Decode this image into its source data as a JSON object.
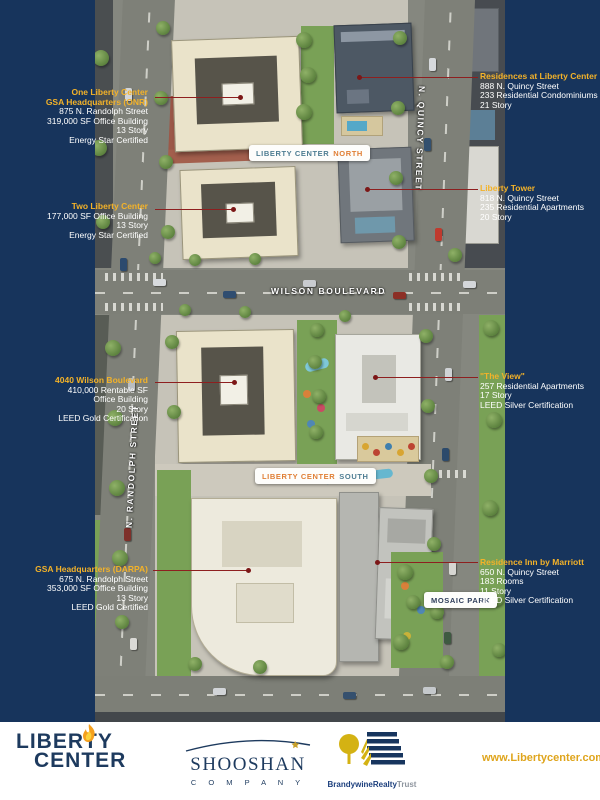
{
  "colors": {
    "background_navy": "#17345c",
    "callout_title_gold": "#f3b229",
    "callout_body_white": "#ffffff",
    "callout_line_red": "#8e1f1f",
    "banner_blue": "#4e7d92",
    "banner_orange": "#e07f35",
    "url_gold": "#dfa51d"
  },
  "callouts": {
    "left": [
      {
        "title": [
          "One Liberty Center",
          "GSA Headquarters (ONR)"
        ],
        "lines": [
          "875 N. Randolph Street",
          "319,000 SF Office Building",
          "13  Story",
          "Energy Star Certified"
        ]
      },
      {
        "title": [
          "Two Liberty Center"
        ],
        "lines": [
          "177,000 SF Office Building",
          "13 Story",
          "Energy Star Certified"
        ]
      },
      {
        "title": [
          "4040 Wilson Boulevard"
        ],
        "lines": [
          "410,000 Rentable SF",
          "Office Building",
          "20 Story",
          "LEED Gold Certification"
        ]
      },
      {
        "title": [
          "GSA Headquarters (DARPA)"
        ],
        "lines": [
          "675 N. Randolph Street",
          "353,000 SF Office Building",
          "13 Story",
          "LEED Gold Certified"
        ]
      }
    ],
    "right": [
      {
        "title": [
          "Residences at Liberty Center"
        ],
        "lines": [
          "888 N. Quincy Street",
          "233 Residential Condominiums",
          "21 Story"
        ]
      },
      {
        "title": [
          "Liberty Tower"
        ],
        "lines": [
          "818 N. Quincy Street",
          "235 Residential Apartments",
          "20 Story"
        ]
      },
      {
        "title": [
          "\"The View\""
        ],
        "lines": [
          "257 Residential Apartments",
          "17 Story",
          "LEED Silver Certification"
        ]
      },
      {
        "title": [
          "Residence Inn by Marriott"
        ],
        "lines": [
          "650 N. Quincy Street",
          "183 Rooms",
          "11 Story",
          "LEED Silver Certification"
        ]
      }
    ]
  },
  "map": {
    "banners": {
      "north": {
        "main": "LIBERTY CENTER",
        "accent": "NORTH"
      },
      "south": {
        "main": "LIBERTY CENTER",
        "accent": "SOUTH"
      },
      "mosaic": "MOSAIC PARK"
    },
    "streets": {
      "wilson": "WILSON BOULEVARD",
      "quincy": "N. QUINCY STREET",
      "randolph": "N. RANDOLPH STREET"
    }
  },
  "footer": {
    "liberty_logo": {
      "line1": "LIBERTY",
      "line2": "CENTER"
    },
    "shooshan": {
      "name": "SHOOSHAN",
      "sub": "C O M P A N Y"
    },
    "brandywine": {
      "bold": "BrandywineRealty",
      "light": "Trust"
    },
    "url": "www.Libertycenter.com"
  }
}
